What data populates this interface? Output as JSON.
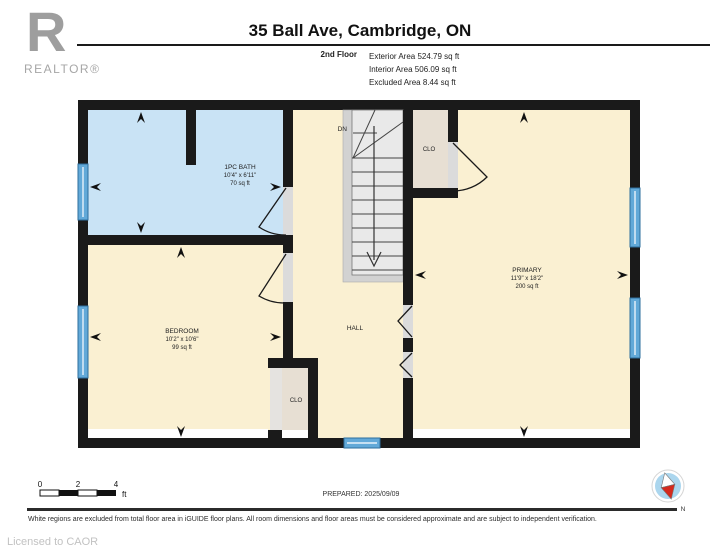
{
  "header": {
    "logo_letter": "R",
    "logo_brand": "REALTOR®",
    "title": "35 Ball Ave, Cambridge, ON",
    "floor_label": "2nd Floor",
    "areas": [
      "Exterior Area 524.79 sq ft",
      "Interior Area 506.09 sq ft",
      "Excluded Area 8.44 sq ft"
    ]
  },
  "plan": {
    "rooms": {
      "bath": {
        "name": "1PC BATH",
        "dims": "10'4\" x 6'11\"",
        "area": "70 sq ft"
      },
      "bedroom": {
        "name": "BEDROOM",
        "dims": "10'2\" x 10'6\"",
        "area": "99 sq ft"
      },
      "primary": {
        "name": "PRIMARY",
        "dims": "11'9\" x 18'2\"",
        "area": "200 sq ft"
      },
      "hall": {
        "name": "HALL"
      },
      "closet_top": {
        "label": "CLO"
      },
      "closet_bottom": {
        "label": "CLO"
      },
      "stair_label": "DN"
    },
    "scale": {
      "t0": "0",
      "t2": "2",
      "t4": "4",
      "unit": "ft"
    },
    "prepared": "PREPARED: 2025/09/09",
    "compass_label": "N"
  },
  "footer": {
    "disclaimer": "White regions are excluded from total floor area in iGUIDE floor plans. All room dimensions and floor areas must be considered approximate and are subject to independent verification.",
    "license": "Licensed to CAOR"
  },
  "colors": {
    "wall": "#1a1a1a",
    "room_cream": "#faf0d2",
    "bath_blue": "#c9e3f5",
    "closet_taupe": "#e7dfd3",
    "stair_gray": "#e9e9e9",
    "stair_band": "#d2d2d2",
    "door_gray": "#dbdbdb",
    "door_light": "#e5e3e0",
    "window_blue": "#62a9d8",
    "excluded_white": "#ffffff",
    "compass_blue": "#abd6ee",
    "compass_red": "#d42a1e"
  }
}
